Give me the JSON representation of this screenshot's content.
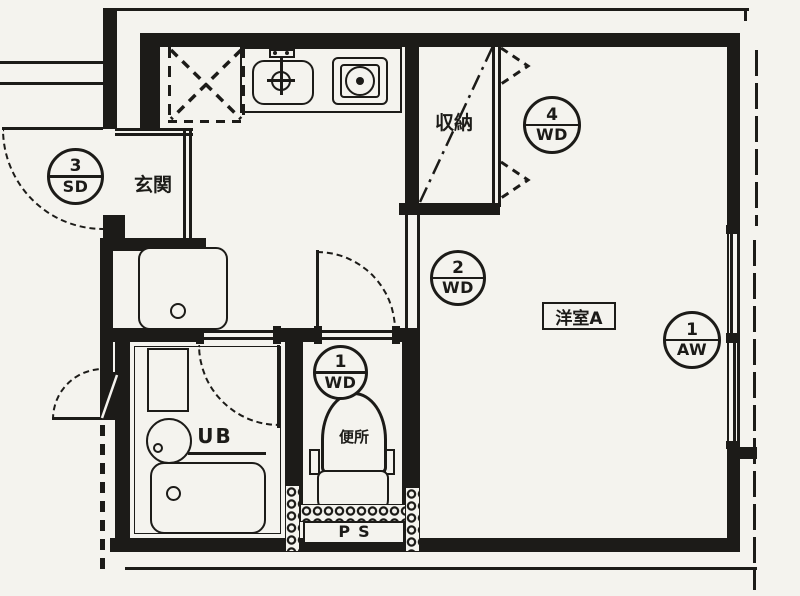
{
  "plan": {
    "title": "1R apartment floor plan",
    "rooms": {
      "entrance_label": "玄関",
      "closet_label": "収納",
      "western_room_label": "洋室A",
      "unit_bath_label": "UB",
      "toilet_label": "便所",
      "pipe_space_label": "PS"
    },
    "openings": [
      {
        "id": "sd3",
        "number": "3",
        "code": "SD"
      },
      {
        "id": "wd4",
        "number": "4",
        "code": "WD"
      },
      {
        "id": "wd2",
        "number": "2",
        "code": "WD"
      },
      {
        "id": "wd1",
        "number": "1",
        "code": "WD"
      },
      {
        "id": "aw1",
        "number": "1",
        "code": "AW"
      }
    ],
    "colors": {
      "ink": "#1c1b18",
      "paper": "#f4f3ee"
    }
  }
}
